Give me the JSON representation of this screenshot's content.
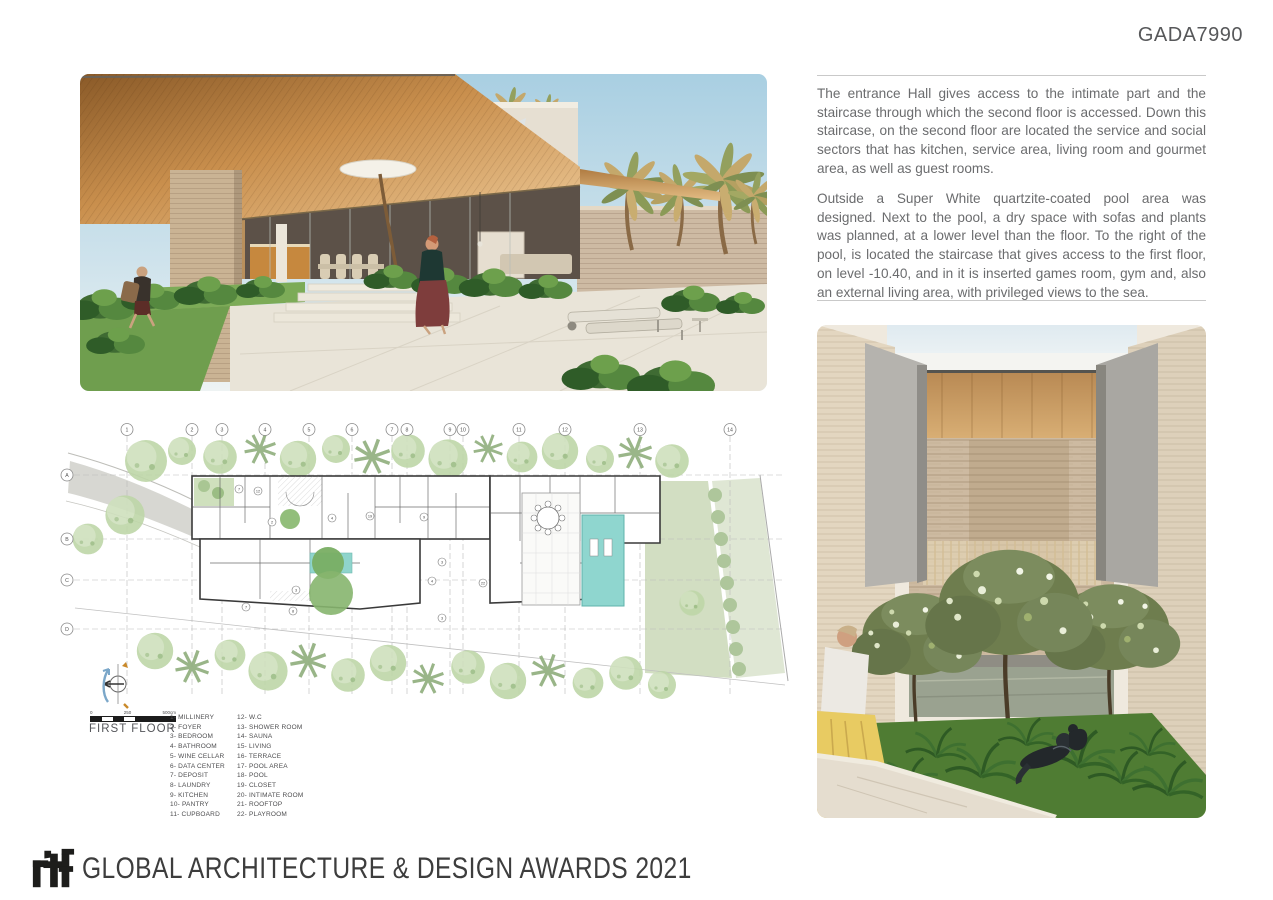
{
  "page": {
    "code": "GADA7990"
  },
  "description": {
    "paragraph1": "The entrance Hall gives access to the intimate part and the staircase through which the second floor is accessed. Down this staircase, on the second floor are located the service and social sectors that has kitchen, service area, living room and gourmet area, as well as guest rooms.",
    "paragraph2": "Outside a Super White quartzite-coated pool area was designed. Next to the pool, a dry space with sofas and plants was planned, at a lower level than the floor. To the right of the pool, is located the staircase that gives access to the first floor, on level -10.40, and in it is inserted games room, gym and, also an external living area, with privileged views to the sea."
  },
  "plan": {
    "title": "FIRST FLOOR",
    "scale_labels": [
      "0",
      "250",
      "500cm"
    ],
    "grid_columns": [
      "1",
      "2",
      "3",
      "4",
      "5",
      "6",
      "7",
      "8",
      "9",
      "10",
      "11",
      "12",
      "13",
      "14"
    ],
    "grid_rows": [
      "A",
      "B",
      "C",
      "D"
    ],
    "legend_col1": [
      "1- MILLINERY",
      "2- FOYER",
      "3- BEDROOM",
      "4- BATHROOM",
      "5- WINE CELLAR",
      "6- DATA CENTER",
      "7- DEPOSIT",
      "8- LAUNDRY",
      "9- KITCHEN",
      "10- PANTRY",
      "11- CUPBOARD"
    ],
    "legend_col2": [
      "12- W.C",
      "13- SHOWER ROOM",
      "14- SAUNA",
      "15- LIVING",
      "16- TERRACE",
      "17- POOL AREA",
      "18- POOL",
      "19- CLOSET",
      "20- INTIMATE ROOM",
      "21- ROOFTOP",
      "22- PLAYROOM"
    ],
    "room_markers": [
      {
        "label": "7",
        "x": 179,
        "y": 66
      },
      {
        "label": "12",
        "x": 198,
        "y": 68
      },
      {
        "label": "2",
        "x": 212,
        "y": 99
      },
      {
        "label": "4",
        "x": 272,
        "y": 95
      },
      {
        "label": "19",
        "x": 310,
        "y": 93
      },
      {
        "label": "3",
        "x": 236,
        "y": 167
      },
      {
        "label": "7",
        "x": 186,
        "y": 184
      },
      {
        "label": "8",
        "x": 233,
        "y": 188
      },
      {
        "label": "9",
        "x": 364,
        "y": 94
      },
      {
        "label": "3",
        "x": 382,
        "y": 139
      },
      {
        "label": "4",
        "x": 372,
        "y": 158
      },
      {
        "label": "22",
        "x": 423,
        "y": 160
      },
      {
        "label": "3",
        "x": 382,
        "y": 195
      }
    ]
  },
  "footer": {
    "logo_text": "rtf",
    "award_text": "GLOBAL ARCHITECTURE & DESIGN AWARDS 2021"
  },
  "colors": {
    "text_gray": "#6b6c6e",
    "heading_gray": "#57585a",
    "rule_gray": "#c9c9c9",
    "pool_teal": "#8fd6cf",
    "plan_green": "#c9dcb6",
    "logo_black": "#1d1d1b"
  }
}
